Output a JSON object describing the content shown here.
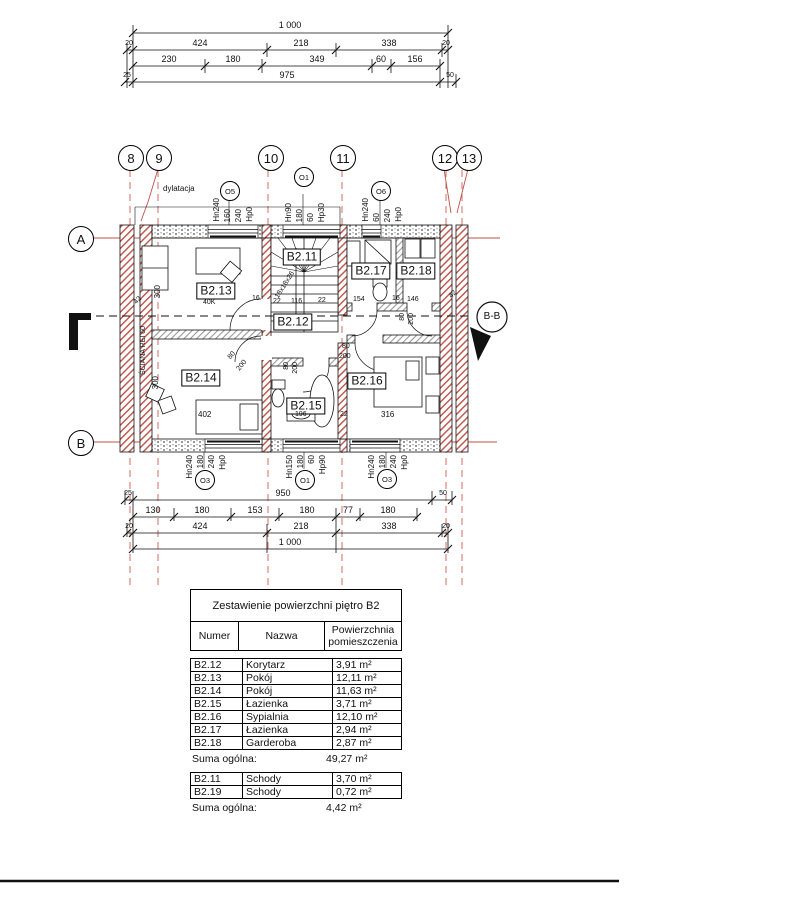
{
  "colors": {
    "line": "#111111",
    "red": "#c05046",
    "red_dash": "#cd5c52"
  },
  "top_dims": {
    "total": "1 000",
    "row2": [
      "20",
      "424",
      "218",
      "338",
      "20"
    ],
    "row3": [
      "230",
      "180",
      "349",
      "60",
      "156"
    ],
    "row4": [
      "25",
      "975",
      "50"
    ]
  },
  "bottom_dims": {
    "row1": [
      "25",
      "950",
      "50"
    ],
    "row2": [
      "130",
      "180",
      "153",
      "180",
      "77",
      "180"
    ],
    "row3": [
      "20",
      "424",
      "218",
      "338",
      "20"
    ],
    "total": "1 000"
  },
  "grid": {
    "cols": [
      "8",
      "9",
      "10",
      "11",
      "12",
      "13"
    ],
    "rows": [
      "A",
      "B"
    ]
  },
  "windows": {
    "top": [
      {
        "id": "O5",
        "l": [
          "Hn240",
          "160",
          "240",
          "Hp0"
        ]
      },
      {
        "id": "O1",
        "l": [
          "Hn90",
          "180",
          "60",
          "Hp30"
        ]
      },
      {
        "id": "O6",
        "l": [
          "Hn240",
          "60",
          "240",
          "Hp0"
        ]
      }
    ],
    "bottom": [
      {
        "id": "O3",
        "l": [
          "Hn240",
          "180",
          "240",
          "Hp0"
        ]
      },
      {
        "id": "O1",
        "l": [
          "Hn150",
          "180",
          "60",
          "Hp90"
        ]
      },
      {
        "id": "O3",
        "l": [
          "Hn240",
          "180",
          "240",
          "Hp0"
        ]
      }
    ]
  },
  "plan": {
    "rooms": {
      "b211": "B2.11",
      "b212": "B2.12",
      "b213": "B2.13",
      "b214": "B2.14",
      "b215": "B2.15",
      "b216": "B2.16",
      "b217": "B2.17",
      "b218": "B2.18"
    },
    "notes": {
      "dylatacja": "dylatacja",
      "sciana": "ŚCIANA REI 60",
      "stairs": "18x18x26",
      "section": "B-B",
      "misc": "40K"
    },
    "dims": {
      "d300a": "300",
      "d300b": "300",
      "d42a": "42",
      "d42b": "42",
      "d16a": "16",
      "d16b": "16",
      "d22a": "22",
      "d22b": "22",
      "d22c": "22",
      "d116": "116",
      "d154": "154",
      "d146": "146",
      "d402": "402",
      "d196": "196",
      "d316": "316"
    },
    "doors": [
      {
        "w": "80",
        "h": "200"
      },
      {
        "w": "80",
        "h": "200"
      },
      {
        "w": "80",
        "h": "200"
      },
      {
        "w": "80",
        "h": "200"
      }
    ]
  },
  "tables": {
    "main": {
      "title": "Zestawienie powierzchni piętro B2",
      "headers": [
        "Numer",
        "Nazwa",
        "Powierzchnia pomieszczenia"
      ],
      "rows": [
        [
          "B2.12",
          "Korytarz",
          "3,91 m²"
        ],
        [
          "B2.13",
          "Pokój",
          "12,11 m²"
        ],
        [
          "B2.14",
          "Pokój",
          "11,63 m²"
        ],
        [
          "B2.15",
          "Łazienka",
          "3,71 m²"
        ],
        [
          "B2.16",
          "Sypialnia",
          "12,10 m²"
        ],
        [
          "B2.17",
          "Łazienka",
          "2,94 m²"
        ],
        [
          "B2.18",
          "Garderoba",
          "2,87 m²"
        ]
      ],
      "total_label": "Suma ogólna:",
      "total_value": "49,27 m²"
    },
    "stairs": {
      "rows": [
        [
          "B2.11",
          "Schody",
          "3,70 m²"
        ],
        [
          "B2.19",
          "Schody",
          "0,72 m²"
        ]
      ],
      "total_label": "Suma ogólna:",
      "total_value": "4,42 m²"
    }
  }
}
